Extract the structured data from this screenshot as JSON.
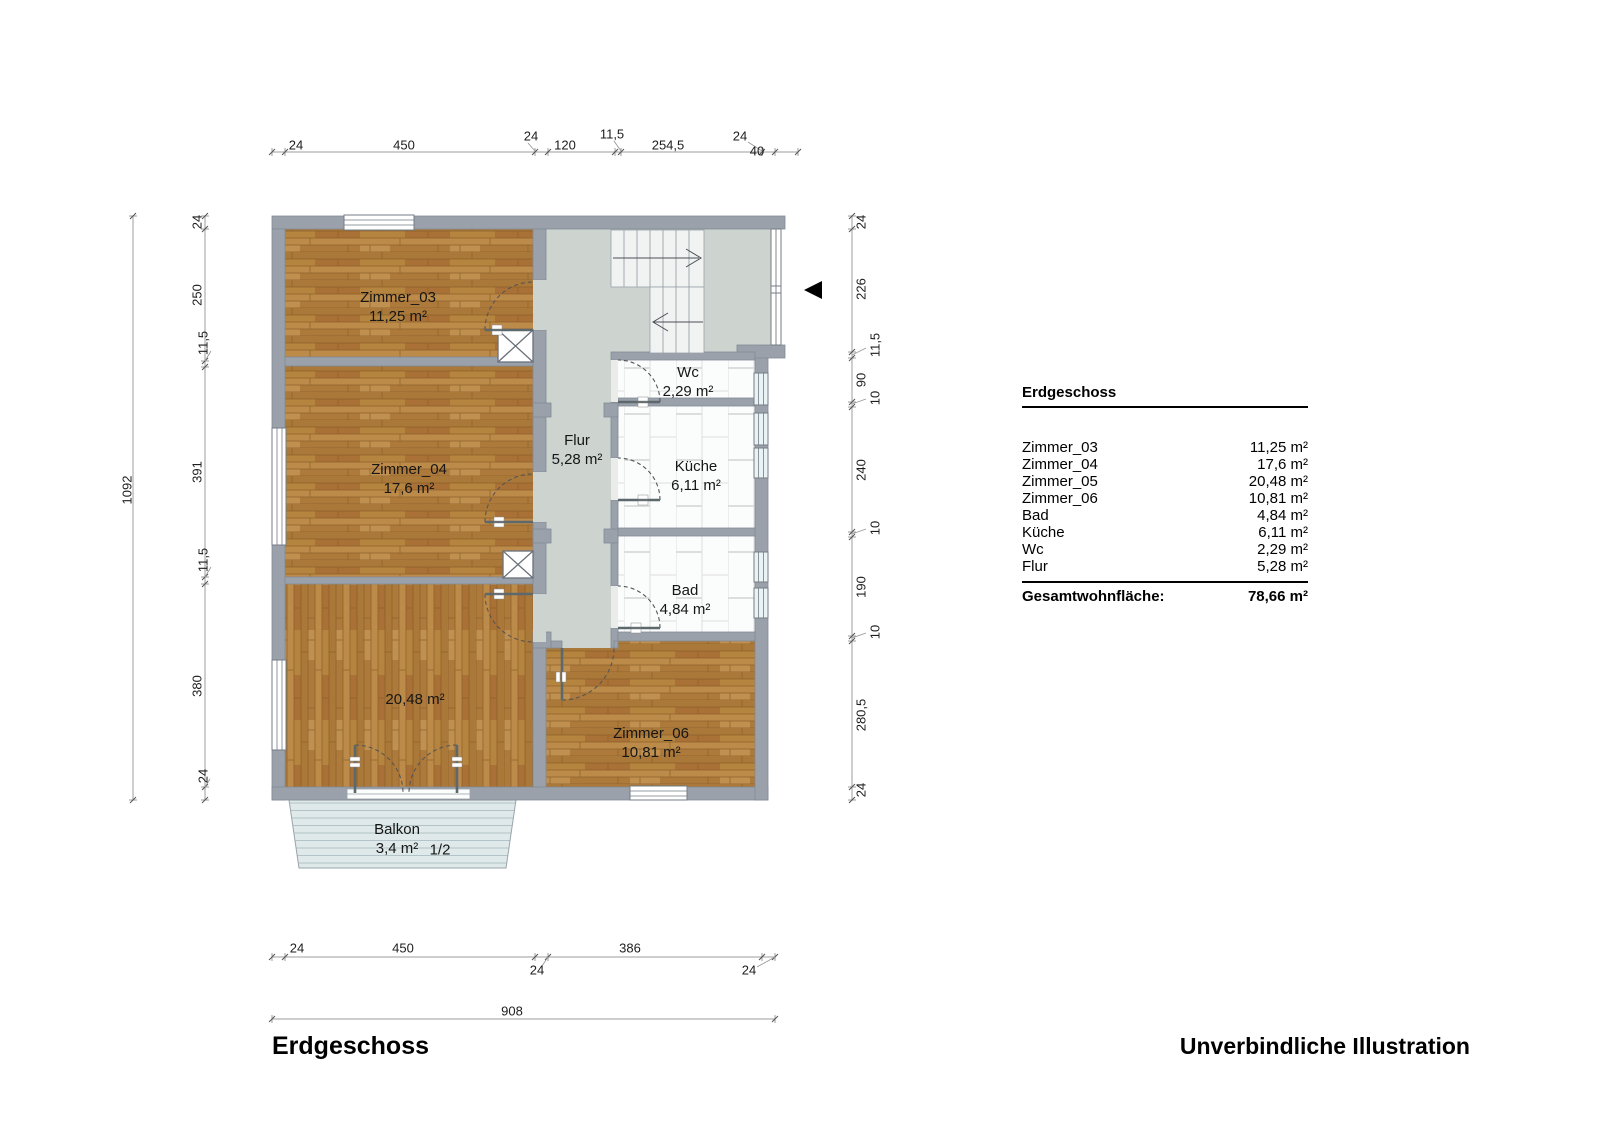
{
  "floor_title": "Erdgeschoss",
  "disclaimer": "Unverbindliche Illustration",
  "legend": {
    "title": "Erdgeschoss",
    "rows": [
      {
        "label": "Zimmer_03",
        "value": "11,25 m²"
      },
      {
        "label": "Zimmer_04",
        "value": "17,6 m²"
      },
      {
        "label": "Zimmer_05",
        "value": "20,48 m²"
      },
      {
        "label": "Zimmer_06",
        "value": "10,81 m²"
      },
      {
        "label": "Bad",
        "value": "4,84 m²"
      },
      {
        "label": "Küche",
        "value": "6,11 m²"
      },
      {
        "label": "Wc",
        "value": "2,29 m²"
      },
      {
        "label": "Flur",
        "value": "5,28 m²"
      }
    ],
    "total_label": "Gesamtwohnfläche:",
    "total_value": "78,66 m²"
  },
  "rooms": {
    "zimmer_03": {
      "name": "Zimmer_03",
      "area": "11,25 m²"
    },
    "zimmer_04": {
      "name": "Zimmer_04",
      "area": "17,6 m²"
    },
    "zimmer_05": {
      "name": "Zimmer_05",
      "area": "20,48 m²"
    },
    "zimmer_06": {
      "name": "Zimmer_06",
      "area": "10,81 m²"
    },
    "bad": {
      "name": "Bad",
      "area": "4,84 m²"
    },
    "kueche": {
      "name": "Küche",
      "area": "6,11 m²"
    },
    "wc": {
      "name": "Wc",
      "area": "2,29 m²"
    },
    "flur": {
      "name": "Flur",
      "area": "5,28 m²"
    },
    "balkon": {
      "name": "Balkon",
      "area": "3,4 m²",
      "note": "1/2"
    }
  },
  "dimensions": {
    "top": [
      "24",
      "450",
      "24",
      "120",
      "11,5",
      "254,5",
      "24",
      "40"
    ],
    "left_total": "1092",
    "left": [
      "24",
      "250",
      "11,5",
      "391",
      "11,5",
      "380",
      "24"
    ],
    "right": [
      "24",
      "226",
      "11,5",
      "90",
      "10",
      "240",
      "10",
      "190",
      "10",
      "280,5",
      "24"
    ],
    "bottom": [
      "24",
      "450",
      "24",
      "386",
      "24"
    ],
    "bottom_total": "908"
  },
  "colors": {
    "wall": "#9aa1ab",
    "wood_floor": "#b28040",
    "corridor_floor": "#cdd4d0",
    "tile_floor": "#fbfcfc",
    "balcony_deck": "#dfe9ea",
    "text": "#000000"
  }
}
